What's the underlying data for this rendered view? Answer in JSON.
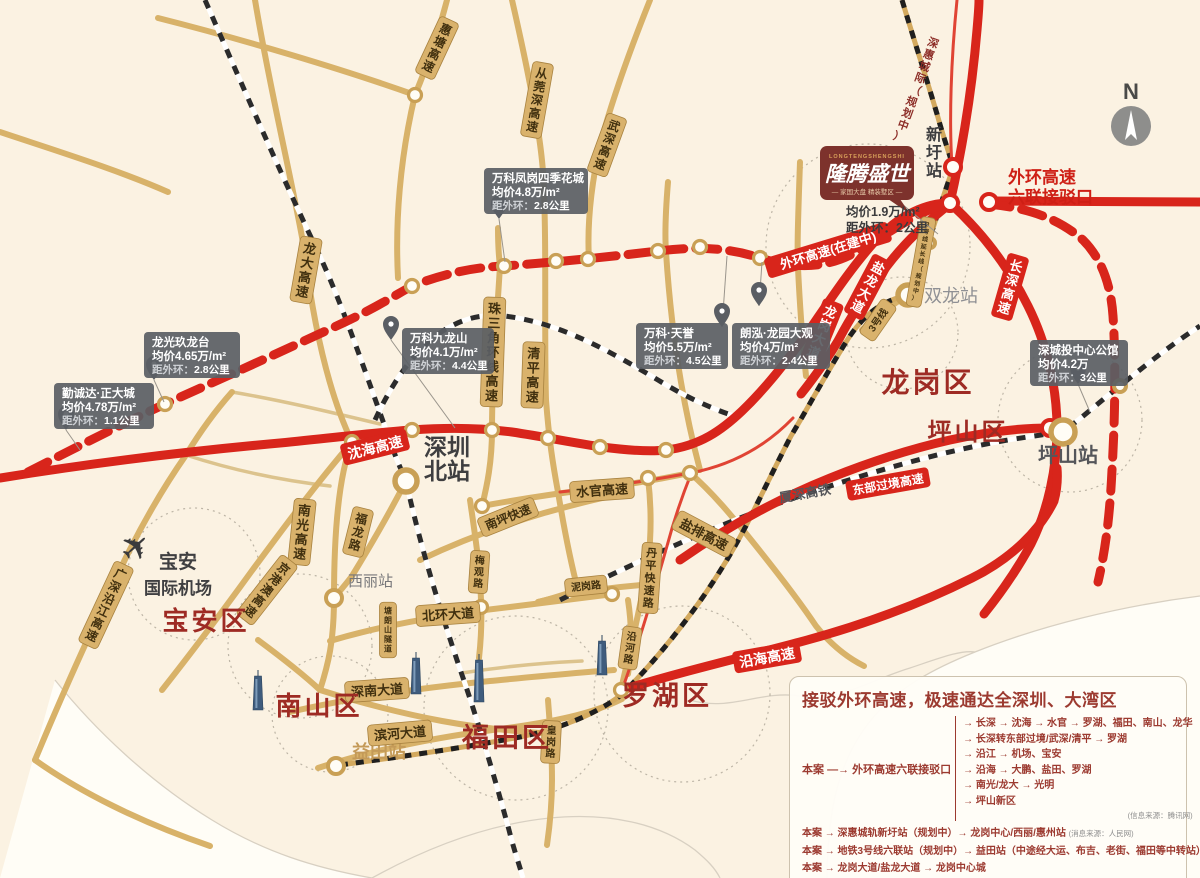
{
  "colors": {
    "bg": "#fbf2e2",
    "gold_road": "#d8b269",
    "gold_light": "#dcc38d",
    "red_road": "#d8251b",
    "district_text": "#9e2b24",
    "legend_text": "#9c3a30",
    "callout_bg": "rgba(90,94,100,0.92)",
    "gold_ring": "#c9a055",
    "sea": "#fffdf6"
  },
  "compass": {
    "label": "N"
  },
  "airport": {
    "icon": "airplane-icon",
    "line1": "宝安",
    "line2": "国际机场"
  },
  "project": {
    "logo_en": "LONGTENGSHENGSHI",
    "logo_cn": "隆腾盛世",
    "logo_tagline": "— 家国大盘 精装墅区 —",
    "price": "均价1.9万/m²",
    "distance": "距外环：2公里",
    "interchange_line1": "外环高速",
    "interchange_line2": "六联接驳口"
  },
  "districts": [
    {
      "name": "宝安区",
      "x": 206,
      "y": 630,
      "s": 26
    },
    {
      "name": "南山区",
      "x": 319,
      "y": 715,
      "s": 26
    },
    {
      "name": "福田区",
      "x": 507,
      "y": 747,
      "s": 27
    },
    {
      "name": "罗湖区",
      "x": 667,
      "y": 705,
      "s": 27
    },
    {
      "name": "龙岗区",
      "x": 928,
      "y": 392,
      "s": 28
    },
    {
      "name": "坪山区",
      "x": 968,
      "y": 440,
      "s": 24
    }
  ],
  "stations": [
    {
      "name": "深圳北站",
      "x": 406,
      "y": 481,
      "r": 11,
      "ring": "gold",
      "lines": [
        "深圳",
        "北站"
      ],
      "lx": 424,
      "ly": 455,
      "ls": 23,
      "lc": "#3e3e40",
      "bold": true
    },
    {
      "name": "西丽站",
      "x": 334,
      "y": 598,
      "r": 8,
      "ring": "gold",
      "lines": [
        "西丽站"
      ],
      "lx": 348,
      "ly": 586,
      "ls": 15,
      "lc": "#77777a",
      "bold": false
    },
    {
      "name": "益田站",
      "x": 336,
      "y": 766,
      "r": 8,
      "ring": "gold",
      "lines": [
        "益田站"
      ],
      "lx": 352,
      "ly": 758,
      "ls": 18,
      "lc": "#c49a58",
      "bold": true
    },
    {
      "name": "双龙站",
      "x": 908,
      "y": 295,
      "r": 10,
      "ring": "gold",
      "lines": [
        "双龙站"
      ],
      "lx": 924,
      "ly": 302,
      "ls": 18,
      "lc": "#8f9094",
      "bold": false
    },
    {
      "name": "坪山站",
      "x": 1063,
      "y": 432,
      "r": 12,
      "ring": "gold",
      "lines": [
        "坪山站"
      ],
      "lx": 1038,
      "ly": 462,
      "ls": 20,
      "lc": "#55565a",
      "bold": true
    },
    {
      "name": "新圩站",
      "x": 953,
      "y": 167,
      "r": 8,
      "ring": "red",
      "stacked": [
        "新",
        "圩",
        "站"
      ],
      "lx": 934,
      "ly": 140,
      "ls": 16,
      "lc": "#3e3e40",
      "bold": true
    },
    {
      "name": "",
      "x": 930,
      "y": 243,
      "r": 5,
      "ring": "gold"
    },
    {
      "name": "",
      "x": 1120,
      "y": 386,
      "r": 6,
      "ring": "gold"
    }
  ],
  "road_labels": [
    {
      "t": "惠塘高速",
      "x": 437,
      "y": 48,
      "rot": 25,
      "o": "v",
      "s": 12,
      "type": "gold"
    },
    {
      "t": "从莞深高速",
      "x": 537,
      "y": 100,
      "rot": 10,
      "o": "v",
      "s": 12,
      "type": "gold"
    },
    {
      "t": "武深高速",
      "x": 607,
      "y": 145,
      "rot": 20,
      "o": "v",
      "s": 12,
      "type": "gold"
    },
    {
      "t": "龙大高速",
      "x": 306,
      "y": 270,
      "rot": 10,
      "o": "v",
      "s": 13,
      "type": "gold"
    },
    {
      "t": "珠三角环线高速",
      "x": 493,
      "y": 352,
      "rot": 2,
      "o": "v",
      "s": 13,
      "type": "gold"
    },
    {
      "t": "清平高速",
      "x": 533,
      "y": 375,
      "rot": 2,
      "o": "v",
      "s": 13,
      "type": "gold"
    },
    {
      "t": "南光高速",
      "x": 302,
      "y": 532,
      "rot": 6,
      "o": "v",
      "s": 13,
      "type": "gold"
    },
    {
      "t": "福龙路",
      "x": 358,
      "y": 532,
      "rot": 14,
      "o": "v",
      "s": 12,
      "type": "gold"
    },
    {
      "t": "梅观路",
      "x": 479,
      "y": 572,
      "rot": 4,
      "o": "v",
      "s": 10,
      "type": "gold"
    },
    {
      "t": "塘朗山隧道",
      "x": 388,
      "y": 630,
      "rot": 0,
      "o": "v",
      "s": 8,
      "type": "gold"
    },
    {
      "t": "南坪快速",
      "x": 508,
      "y": 517,
      "rot": -22,
      "o": "h",
      "s": 12,
      "type": "gold"
    },
    {
      "t": "水官高速",
      "x": 602,
      "y": 490,
      "rot": -4,
      "o": "h",
      "s": 13,
      "type": "gold"
    },
    {
      "t": "盐排高速",
      "x": 704,
      "y": 534,
      "rot": 28,
      "o": "h",
      "s": 13,
      "type": "gold"
    },
    {
      "t": "丹平快速路",
      "x": 650,
      "y": 578,
      "rot": 4,
      "o": "v",
      "s": 11,
      "type": "gold"
    },
    {
      "t": "泥岗路",
      "x": 586,
      "y": 586,
      "rot": -6,
      "o": "h",
      "s": 10,
      "type": "gold"
    },
    {
      "t": "北环大道",
      "x": 448,
      "y": 614,
      "rot": -4,
      "o": "h",
      "s": 13,
      "type": "gold"
    },
    {
      "t": "深南大道",
      "x": 377,
      "y": 690,
      "rot": -4,
      "o": "h",
      "s": 13,
      "type": "gold"
    },
    {
      "t": "滨河大道",
      "x": 400,
      "y": 733,
      "rot": -5,
      "o": "h",
      "s": 13,
      "type": "gold"
    },
    {
      "t": "皇岗路",
      "x": 551,
      "y": 742,
      "rot": 3,
      "o": "v",
      "s": 10,
      "type": "gold"
    },
    {
      "t": "沿河路",
      "x": 630,
      "y": 648,
      "rot": 8,
      "o": "v",
      "s": 10,
      "type": "gold"
    },
    {
      "t": "京港澳高速",
      "x": 267,
      "y": 590,
      "rot": 38,
      "o": "v",
      "s": 12,
      "type": "gold"
    },
    {
      "t": "广深沿江高速",
      "x": 106,
      "y": 605,
      "rot": 25,
      "o": "v",
      "s": 12,
      "type": "gold"
    },
    {
      "t": "3号线",
      "x": 878,
      "y": 320,
      "rot": -55,
      "o": "h",
      "s": 10,
      "type": "gold"
    },
    {
      "t": "3号线延长线（规划中）",
      "x": 921,
      "y": 262,
      "rot": 10,
      "o": "v",
      "s": 6,
      "type": "gold"
    },
    {
      "t": "沈海高速",
      "x": 375,
      "y": 447,
      "rot": -14,
      "o": "h",
      "s": 14,
      "type": "red"
    },
    {
      "t": "长深高速",
      "x": 1010,
      "y": 287,
      "rot": 16,
      "o": "v",
      "s": 13,
      "type": "red"
    },
    {
      "t": "龙岗大道",
      "x": 822,
      "y": 332,
      "rot": 22,
      "o": "v",
      "s": 13,
      "type": "red"
    },
    {
      "t": "盐龙大道",
      "x": 868,
      "y": 287,
      "rot": 28,
      "o": "v",
      "s": 13,
      "type": "red"
    },
    {
      "t": "沿海高速",
      "x": 767,
      "y": 657,
      "rot": -10,
      "o": "h",
      "s": 14,
      "type": "red"
    },
    {
      "t": "东部过境高速",
      "x": 888,
      "y": 484,
      "rot": -10,
      "o": "h",
      "s": 12,
      "type": "red"
    },
    {
      "t": "外环高速(在建中)",
      "x": 828,
      "y": 250,
      "rot": -17,
      "o": "h",
      "s": 13,
      "type": "red"
    },
    {
      "t": "厦深高铁",
      "x": 805,
      "y": 493,
      "rot": -10,
      "o": "h",
      "s": 13,
      "type": "plain"
    },
    {
      "t": "深惠城际（规划中）",
      "x": 916,
      "y": 90,
      "rot": 20,
      "o": "v",
      "s": 11,
      "type": "darkred"
    }
  ],
  "callouts": [
    {
      "name": "万科凤岗四季花城",
      "price": "均价4.8万/m²",
      "distance_label": "距外环：",
      "distance_value": "2.8公里",
      "x": 484,
      "y": 168,
      "w": 104,
      "pin": [
        499,
        219
      ],
      "line": [
        505,
        262
      ]
    },
    {
      "name": "万科九龙山",
      "price": "均价4.1万/m²",
      "distance_label": "距外环：",
      "distance_value": "4.4公里",
      "x": 402,
      "y": 328,
      "w": 92,
      "pin": [
        391,
        340
      ],
      "line": [
        455,
        428
      ]
    },
    {
      "name": "万科·天誉",
      "price": "均价5.5万/m²",
      "distance_label": "距外环：",
      "distance_value": "4.5公里",
      "x": 636,
      "y": 323,
      "w": 92,
      "pin": [
        722,
        327
      ],
      "line": [
        727,
        256
      ]
    },
    {
      "name": "朗泓·龙园大观",
      "price": "均价4万/m²",
      "distance_label": "距外环：",
      "distance_value": "2.4公里",
      "x": 732,
      "y": 323,
      "w": 98,
      "pin": [
        759,
        306
      ],
      "line": [
        762,
        262
      ]
    },
    {
      "name": "龙光玖龙台",
      "price": "均价4.65万/m²",
      "distance_label": "距外环：",
      "distance_value": "2.8公里",
      "x": 144,
      "y": 332,
      "w": 96,
      "pin": [
        154,
        380
      ],
      "line": [
        164,
        402
      ]
    },
    {
      "name": "勤诚达·正大城",
      "price": "均价4.78万/m²",
      "distance_label": "距外环：",
      "distance_value": "1.1公里",
      "x": 54,
      "y": 383,
      "w": 100,
      "pin": [
        66,
        430
      ],
      "line": [
        80,
        450
      ]
    },
    {
      "name": "深城投中心公馆",
      "price": "均价4.2万",
      "distance_label": "距外环：",
      "distance_value": "3公里",
      "x": 1030,
      "y": 340,
      "w": 98,
      "pin": [
        1078,
        384
      ],
      "line": [
        1090,
        412
      ]
    }
  ],
  "legend": {
    "title": "接驳外环高速，极速通达全深圳、大湾区",
    "hub_from": "本案",
    "hub_arrow": "—→",
    "hub_to": "外环高速六联接驳口",
    "branches": [
      "→ 长深 → 沈海 → 水官 → 罗湖、福田、南山、龙华",
      "→ 长深转东部过境/武深/清平 → 罗湖",
      "→ 沿江 → 机场、宝安",
      "→ 沿海 → 大鹏、盐田、罗湖",
      "→ 南光/龙大 → 光明",
      "→ 坪山新区"
    ],
    "branches_source": "(信息来源：腾讯网)",
    "routes": [
      {
        "text": "本案 → 深惠城轨新圩站（规划中）→ 龙岗中心/西丽/惠州站",
        "note": "(消息来源：人民网)"
      },
      {
        "text": "本案 → 地铁3号线六联站（规划中）→ 益田站（中途经大运、布吉、老街、福田等中转站）",
        "note": ""
      },
      {
        "text": "本案 → 龙岗大道/盐龙大道 → 龙岗中心城",
        "note": ""
      }
    ]
  },
  "map_paths": {
    "sea": [
      "M55,680 C95,730 150,782 212,820 C264,852 315,868 372,878 L0,878 Z",
      "M1200,596 C1120,606 1040,626 975,652 C930,670 900,688 878,712 C852,740 838,775 832,812 C828,840 827,860 827,878 L1200,878 Z"
    ],
    "coast": [
      "M55,680 C95,730 150,782 212,820 C264,852 315,868 372,878",
      "M1200,596 C1120,606 1040,626 975,652 C930,670 900,688 878,712 C852,740 838,775 832,812 C828,840 827,860 827,878",
      "M372,878 C430,846 490,824 550,818 C610,812 660,824 695,850 C707,860 715,868 720,878",
      "M690,700 C730,712 760,690 800,696 C840,702 870,680 910,668 C940,658 960,650 975,652"
    ],
    "dotted_circles": [
      [
        868,
        246,
        102
      ],
      [
        902,
        333,
        56
      ],
      [
        1070,
        420,
        72
      ],
      [
        300,
        646,
        72
      ],
      [
        194,
        574,
        66
      ],
      [
        516,
        708,
        92
      ],
      [
        682,
        694,
        88
      ],
      [
        330,
        714,
        58
      ]
    ],
    "gold": [
      "M255,0 C270,90 292,180 304,248 C314,330 330,396 352,442 C340,472 334,525 334,598 C334,642 328,665 320,690",
      "M512,0 C528,70 540,130 543,172 C547,240 544,330 546,400 C549,440 553,465 558,492 C564,528 570,560 578,590",
      "M447,0 C438,35 428,64 415,95 C400,158 395,222 398,278",
      "M415,95 C345,70 245,40 158,18",
      "M650,0 C630,50 612,100 600,145 C591,186 587,226 589,260",
      "M668,182 C665,218 665,238 666,252 C671,330 682,402 700,470",
      "M800,162 C798,220 797,248 798,268 C801,330 804,355 806,376",
      "M498,228 C498,248 499,258 500,266 C496,330 492,380 492,430 C492,462 487,486 482,506",
      "M482,506 C520,499 560,493 600,488 C640,483 666,478 690,473",
      "M690,473 C712,492 732,516 756,546 C780,576 800,602 816,626 C832,646 848,658 864,666",
      "M420,560 C460,541 500,526 544,513 C570,506 590,500 612,496",
      "M648,478 C653,520 651,560 641,600 C633,640 626,666 621,690",
      "M538,602 C568,594 604,588 642,585",
      "M330,641 C380,626 440,615 510,607 C552,602 582,598 614,594",
      "M290,712 C350,698 420,688 490,681 C532,677 572,673 614,670",
      "M318,768 C370,751 430,738 500,729 C552,722 592,714 622,699",
      "M406,481 C391,510 371,545 352,576 C346,584 340,591 334,598",
      "M470,500 C475,535 480,566 481,600 C482,622 481,640 479,658",
      "M548,700 C550,726 552,752 552,780 C552,804 550,824 547,845",
      "M628,600 C632,626 632,650 628,674",
      "M352,442 C316,484 282,530 251,572 C222,612 192,652 162,690",
      "M35,760 C60,700 84,646 108,596 C130,546 156,498 186,455 C200,432 216,410 232,392",
      "M320,690 C358,702 400,713 442,721 C480,728 512,731 540,733",
      "M258,640 C285,660 305,676 320,690",
      "M35,760 C80,792 140,822 210,846",
      "M862,330 C880,314 894,303 908,295",
      "M578,590 C560,596 548,600 538,602",
      "M0,132 C60,152 118,170 168,192"
    ],
    "gold_thin": [
      "M462,673 C500,667 540,663 582,661",
      "M186,455 C232,470 278,480 330,486",
      "M232,392 C280,400 330,412 380,424"
    ],
    "railways_bw": [
      "M205,0 C240,80 278,168 318,252 C344,308 368,380 394,452 C399,466 403,473 406,481 C420,545 440,610 461,672 C477,718 494,775 509,830 C514,850 519,864 523,878",
      "M560,600 C640,560 720,523 800,496 C868,473 938,452 1008,440 C1028,437 1046,434 1063,432 C1084,416 1103,399 1120,386 C1148,363 1175,342 1200,326",
      "M375,420 C408,348 452,310 504,316 C558,322 608,350 658,380 C684,396 710,408 734,416"
    ],
    "railways_gold": [
      "M340,765 C400,757 462,748 520,737 C560,729 598,713 621,695 C648,669 674,637 698,604 C718,576 736,546 751,516 C764,490 777,463 791,436 C809,406 826,374 846,342 C866,310 886,300 908,295",
      "M908,295 C919,268 929,241 937,216 C944,194 949,180 953,168",
      "M902,0 C914,40 927,80 937,114 C944,139 949,153 953,166"
    ],
    "red_thin": [
      "M622,690 C640,640 654,592 667,546 C675,516 683,494 691,474",
      "M560,492 C615,486 665,478 700,471 C738,462 768,444 793,418",
      "M957,0 C951,60 949,120 952,166"
    ],
    "red": [
      "M0,478 C80,465 180,452 280,443 C340,437 380,432 412,430 C452,427 482,428 512,432 C545,437 575,443 602,447 C625,450 648,452 666,450 C700,446 722,430 742,411 C766,388 786,362 808,332 C830,300 852,266 878,238 C900,215 926,203 950,203",
      "M950,203 C984,234 1010,270 1028,306 C1047,344 1057,388 1057,428 C1057,468 1048,510 1031,544 C1016,572 1000,594 984,614",
      "M950,203 C962,150 972,90 977,30 C978,18 979,8 979,0",
      "M990,201 L1200,202",
      "M946,207 C922,226 903,245 887,266 C869,289 852,314 838,341 C826,361 813,379 801,394",
      "M680,560 C730,525 780,498 830,478 C870,462 910,449 950,440 C986,432 1020,428 1050,428",
      "M622,690 C680,672 740,658 800,642 C860,626 920,604 972,578 C1012,558 1040,530 1054,501 C1057,490 1058,480 1057,468"
    ],
    "red_dashed": [
      "M28,472 C75,448 120,425 165,404 C225,377 285,350 345,322 C375,308 394,296 412,286 C448,272 478,267 504,266 C558,262 608,257 658,251 C698,246 730,248 760,258 C798,270 828,268 858,251 C884,236 914,214 940,206",
      "M988,204 C1028,208 1058,218 1083,240 C1102,259 1111,286 1113,316 C1116,360 1115,420 1112,470 C1110,512 1106,548 1098,582"
    ],
    "junctions": [
      [
        165,
        404
      ],
      [
        412,
        286
      ],
      [
        504,
        266
      ],
      [
        556,
        261
      ],
      [
        588,
        259
      ],
      [
        658,
        251
      ],
      [
        700,
        247
      ],
      [
        760,
        258
      ],
      [
        412,
        430
      ],
      [
        492,
        430
      ],
      [
        548,
        438
      ],
      [
        600,
        447
      ],
      [
        666,
        450
      ],
      [
        352,
        442
      ],
      [
        482,
        506
      ],
      [
        690,
        473
      ],
      [
        648,
        478
      ],
      [
        612,
        594
      ],
      [
        621,
        690
      ],
      [
        415,
        95
      ],
      [
        481,
        607
      ]
    ],
    "red_junctions": [
      [
        950,
        203
      ],
      [
        989,
        202
      ],
      [
        1050,
        428
      ]
    ],
    "buildings": [
      [
        258,
        710,
        34
      ],
      [
        416,
        694,
        36
      ],
      [
        479,
        702,
        42
      ],
      [
        602,
        675,
        34
      ]
    ]
  }
}
